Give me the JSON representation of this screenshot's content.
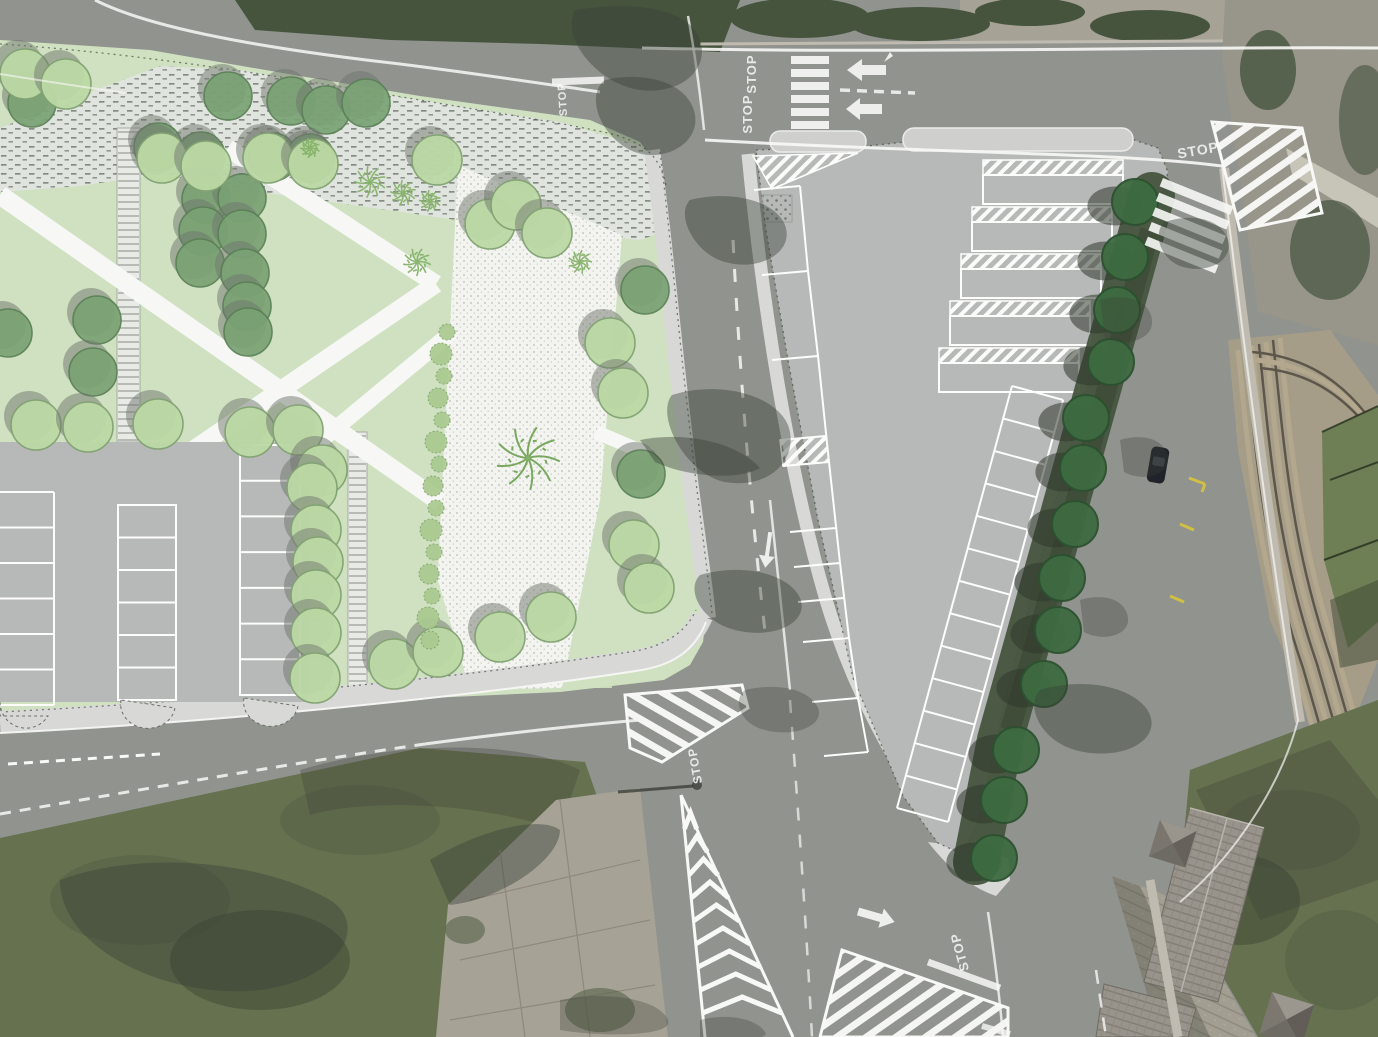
{
  "map": {
    "kind": "aerial-orthophoto-with-landscape-plan-overlay",
    "road_markings": {
      "stop_labels": [
        {
          "text": "STOP",
          "x": 756,
          "y": 74,
          "rotate": -90,
          "size": 13,
          "opacity": 0.8
        },
        {
          "text": "STOP",
          "x": 752,
          "y": 114,
          "rotate": -90,
          "size": 13,
          "opacity": 0.8
        },
        {
          "text": "STOP",
          "x": 566,
          "y": 99,
          "rotate": -94,
          "size": 11,
          "opacity": 0.75
        },
        {
          "text": "STOP",
          "x": 1199,
          "y": 155,
          "rotate": -10,
          "size": 14,
          "opacity": 0.7
        },
        {
          "text": "STOP",
          "x": 699,
          "y": 765,
          "rotate": -100,
          "size": 12,
          "opacity": 0.85
        },
        {
          "text": "STOP",
          "x": 964,
          "y": 951,
          "rotate": -105,
          "size": 13,
          "opacity": 0.85
        }
      ]
    },
    "trees": {
      "park_light": [
        [
          25,
          74
        ],
        [
          66,
          84
        ],
        [
          162,
          158
        ],
        [
          206,
          166
        ],
        [
          268,
          158
        ],
        [
          313,
          164
        ],
        [
          437,
          160
        ],
        [
          490,
          224
        ],
        [
          516,
          205
        ],
        [
          547,
          233
        ],
        [
          36,
          425
        ],
        [
          88,
          427
        ],
        [
          158,
          424
        ],
        [
          250,
          432
        ],
        [
          298,
          430
        ],
        [
          322,
          470
        ],
        [
          312,
          488
        ],
        [
          316,
          530
        ],
        [
          318,
          562
        ],
        [
          316,
          595
        ],
        [
          316,
          633
        ],
        [
          315,
          678
        ],
        [
          394,
          664
        ],
        [
          438,
          652
        ],
        [
          500,
          637
        ],
        [
          551,
          617
        ],
        [
          610,
          343
        ],
        [
          623,
          393
        ],
        [
          634,
          545
        ],
        [
          649,
          588
        ]
      ],
      "park_dark": [
        [
          32,
          103
        ],
        [
          228,
          96
        ],
        [
          291,
          101
        ],
        [
          326,
          110
        ],
        [
          366,
          103
        ],
        [
          158,
          147
        ],
        [
          201,
          156
        ],
        [
          273,
          157
        ],
        [
          310,
          158
        ],
        [
          206,
          199
        ],
        [
          242,
          198
        ],
        [
          203,
          231
        ],
        [
          242,
          234
        ],
        [
          200,
          263
        ],
        [
          245,
          273
        ],
        [
          247,
          306
        ],
        [
          248,
          332
        ],
        [
          97,
          320
        ],
        [
          93,
          372
        ],
        [
          8,
          333
        ],
        [
          645,
          290
        ],
        [
          641,
          474
        ]
      ],
      "street": [
        [
          1135,
          202
        ],
        [
          1125,
          257
        ],
        [
          1117,
          310
        ],
        [
          1111,
          362
        ],
        [
          1086,
          418
        ],
        [
          1083,
          468
        ],
        [
          1075,
          524
        ],
        [
          1062,
          578
        ],
        [
          1058,
          630
        ],
        [
          1044,
          684
        ],
        [
          1016,
          750
        ],
        [
          1004,
          800
        ],
        [
          994,
          858
        ]
      ]
    },
    "shrub_row": [
      [
        447,
        332,
        8
      ],
      [
        441,
        354,
        11
      ],
      [
        444,
        376,
        8
      ],
      [
        438,
        398,
        10
      ],
      [
        442,
        420,
        8
      ],
      [
        436,
        442,
        11
      ],
      [
        439,
        464,
        8
      ],
      [
        433,
        486,
        10
      ],
      [
        436,
        508,
        8
      ],
      [
        431,
        530,
        11
      ],
      [
        434,
        552,
        8
      ],
      [
        429,
        574,
        10
      ],
      [
        432,
        596,
        8
      ],
      [
        428,
        618,
        11
      ],
      [
        430,
        640,
        9
      ]
    ],
    "palms": [
      [
        370,
        182,
        16
      ],
      [
        403,
        193,
        13
      ],
      [
        430,
        201,
        11
      ],
      [
        417,
        262,
        14
      ],
      [
        580,
        262,
        12
      ],
      [
        528,
        458,
        32
      ],
      [
        310,
        148,
        10
      ]
    ],
    "parking": {
      "left_lot_columns": [
        {
          "x": 0,
          "w": 54,
          "yTop": 492,
          "yBottom": 705,
          "lines": 7,
          "box": false
        },
        {
          "x": 118,
          "w": 58,
          "yTop": 505,
          "yBottom": 700,
          "lines": 7,
          "box": true
        },
        {
          "x": 240,
          "w": 60,
          "yTop": 445,
          "yBottom": 695,
          "lines": 8,
          "box": true
        }
      ],
      "plaza_bays": [
        [
          983,
          160
        ],
        [
          972,
          207
        ],
        [
          961,
          254
        ],
        [
          950,
          301
        ],
        [
          939,
          348
        ]
      ],
      "plaza_bay_size": {
        "w": 140,
        "h": 44,
        "hatch_h": 15
      },
      "plaza_left_dividers": [
        [
          754,
          190,
          800,
          186
        ],
        [
          762,
          275,
          808,
          271
        ],
        [
          772,
          360,
          818,
          356
        ],
        [
          780,
          440,
          826,
          436
        ],
        [
          783,
          466,
          829,
          462
        ],
        [
          790,
          532,
          836,
          528
        ],
        [
          794,
          567,
          840,
          563
        ],
        [
          798,
          602,
          844,
          598
        ],
        [
          803,
          642,
          849,
          638
        ],
        [
          812,
          702,
          858,
          698
        ],
        [
          824,
          756,
          868,
          752
        ]
      ],
      "plaza_left_rail": [
        [
          800,
          186
        ],
        [
          808,
          271
        ],
        [
          818,
          356
        ],
        [
          829,
          462
        ],
        [
          840,
          563
        ],
        [
          849,
          638
        ],
        [
          858,
          698
        ],
        [
          868,
          752
        ]
      ],
      "plaza_diagonal_row": {
        "x1": 1012,
        "y1": 386,
        "x2": 897,
        "y2": 808,
        "depth": 53,
        "count": 13
      }
    },
    "chevron_island_tall": {
      "apex": [
        681,
        795
      ],
      "base_left": [
        705,
        1037
      ],
      "base_right": [
        793,
        1037
      ],
      "count": 9,
      "step": 23
    },
    "colors": {
      "asphalt": "#90938e",
      "plan_gray": "#b7b9b8",
      "park_green": "#cfe1c1",
      "plan_sidewalk": "#d8d9d7",
      "tree_light": "#bcd9a5",
      "tree_dark": "#7aa274",
      "street_tree": "#3e6b41",
      "marking_white": "#f8f8f6",
      "marking_yellow": "#d9c33d",
      "grass": "#66714f",
      "steps_tan": "#b3a88e",
      "field_green": "#6f7f55"
    }
  }
}
